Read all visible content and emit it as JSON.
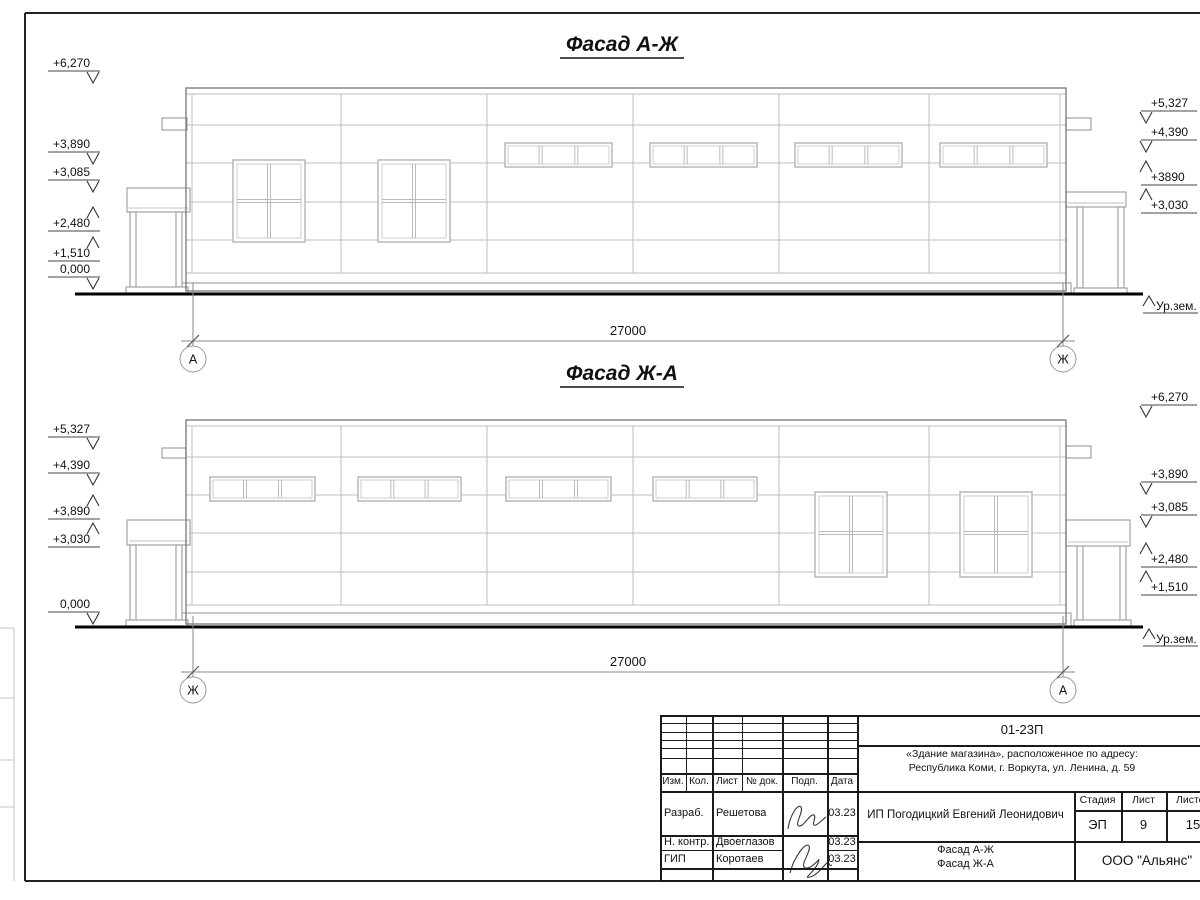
{
  "drawing": {
    "facade_top": {
      "title": "Фасад А-Ж",
      "axis_left": "А",
      "axis_right": "Ж",
      "length_dim": "27000",
      "ground_label": "Ур.зем.",
      "marks_left": [
        {
          "label": "+6,270",
          "dir": "down",
          "y": 71
        },
        {
          "label": "+3,890",
          "dir": "down",
          "y": 152
        },
        {
          "label": "+3,085",
          "dir": "down",
          "y": 180
        },
        {
          "label": "+2,480",
          "dir": "up",
          "y": 231
        },
        {
          "label": "+1,510",
          "dir": "up",
          "y": 261
        },
        {
          "label": "0,000",
          "dir": "down",
          "y": 277
        }
      ],
      "marks_right": [
        {
          "label": "+5,327",
          "dir": "down",
          "y": 111
        },
        {
          "label": "+4,390",
          "dir": "down",
          "y": 140
        },
        {
          "label": "+3890",
          "dir": "up",
          "y": 185
        },
        {
          "label": "+3,030",
          "dir": "up",
          "y": 213
        }
      ]
    },
    "facade_bottom": {
      "title": "Фасад Ж-А",
      "axis_left": "Ж",
      "axis_right": "А",
      "length_dim": "27000",
      "ground_label": "Ур.зем.",
      "marks_left": [
        {
          "label": "+5,327",
          "dir": "down",
          "y": 437
        },
        {
          "label": "+4,390",
          "dir": "down",
          "y": 473
        },
        {
          "label": "+3,890",
          "dir": "up",
          "y": 519
        },
        {
          "label": "+3,030",
          "dir": "up",
          "y": 547
        },
        {
          "label": "0,000",
          "dir": "down",
          "y": 612
        }
      ],
      "marks_right": [
        {
          "label": "+6,270",
          "dir": "down",
          "y": 405
        },
        {
          "label": "+3,890",
          "dir": "down",
          "y": 482
        },
        {
          "label": "+3,085",
          "dir": "down",
          "y": 515
        },
        {
          "label": "+2,480",
          "dir": "up",
          "y": 567
        },
        {
          "label": "+1,510",
          "dir": "up",
          "y": 595
        }
      ]
    }
  },
  "title_block": {
    "doc_number": "01-23П",
    "project_line1": "«Здание магазина», расположенное по адресу:",
    "project_line2": "Республика Коми, г. Воркута, ул. Ленина, д. 59",
    "cols": {
      "izm": "Изм.",
      "kol": "Кол.",
      "list": "Лист",
      "doc": "№ док.",
      "podp": "Подп.",
      "data": "Дата"
    },
    "rows": [
      {
        "role": "Разраб.",
        "name": "Решетова",
        "date": "03.23"
      },
      {
        "role": "Н. контр.",
        "name": "Двоеглазов",
        "date": "03.23"
      },
      {
        "role": "ГИП",
        "name": "Коротаев",
        "date": "03.23"
      }
    ],
    "client": "ИП Погодицкий Евгений Леонидович",
    "stage_header": {
      "stage": "Стадия",
      "sheet": "Лист",
      "sheets": "Листов"
    },
    "stage_values": {
      "stage": "ЭП",
      "sheet": "9",
      "sheets": "15"
    },
    "sheet_title_line1": "Фасад А-Ж",
    "sheet_title_line2": "Фасад Ж-А",
    "company": "ООО \"Альянс\""
  }
}
